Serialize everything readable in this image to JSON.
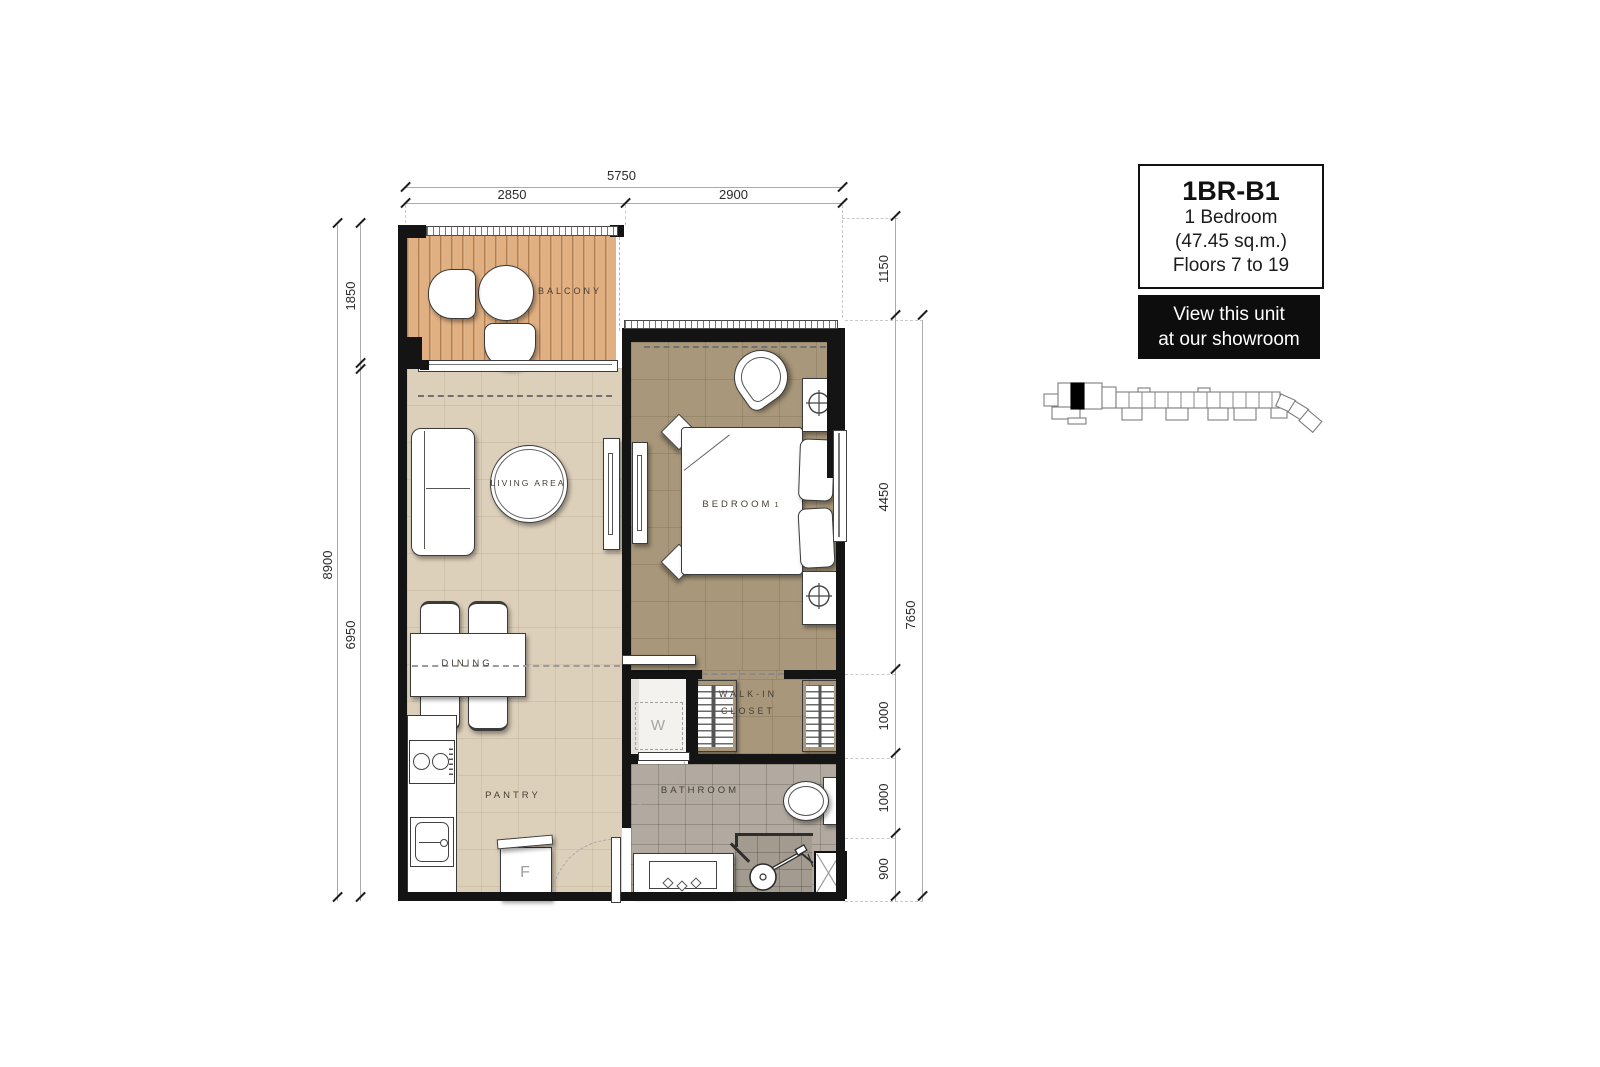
{
  "unit_card": {
    "code": "1BR-B1",
    "type": "1 Bedroom",
    "area": "(47.45 sq.m.)",
    "floors": "Floors 7 to 19"
  },
  "cta": {
    "line1": "View this unit",
    "line2": "at our showroom"
  },
  "rooms": {
    "balcony": "BALCONY",
    "living": "LIVING AREA",
    "dining": "DINING",
    "pantry": "PANTRY",
    "bedroom": "BEDROOM",
    "bedroom_no": "1",
    "walk_in_line1": "WALK-IN",
    "walk_in_line2": "CLOSET",
    "bathroom": "BATHROOM",
    "washer": "W",
    "fridge": "F"
  },
  "dimensions": {
    "top_total": "5750",
    "top_left": "2850",
    "top_right": "2900",
    "left_total": "8900",
    "left_top": "1850",
    "left_bottom": "6950",
    "right_total": "7650",
    "right_segments": [
      "1150",
      "4450",
      "1000",
      "1000",
      "900"
    ]
  },
  "colors": {
    "wall": "#141414",
    "balcony_wood": "#e0b083",
    "floor_light": "#ddd0ba",
    "floor_tan": "#a8977a",
    "bath_tile": "#b2aaa0",
    "accent_black": "#0d0d0d"
  }
}
